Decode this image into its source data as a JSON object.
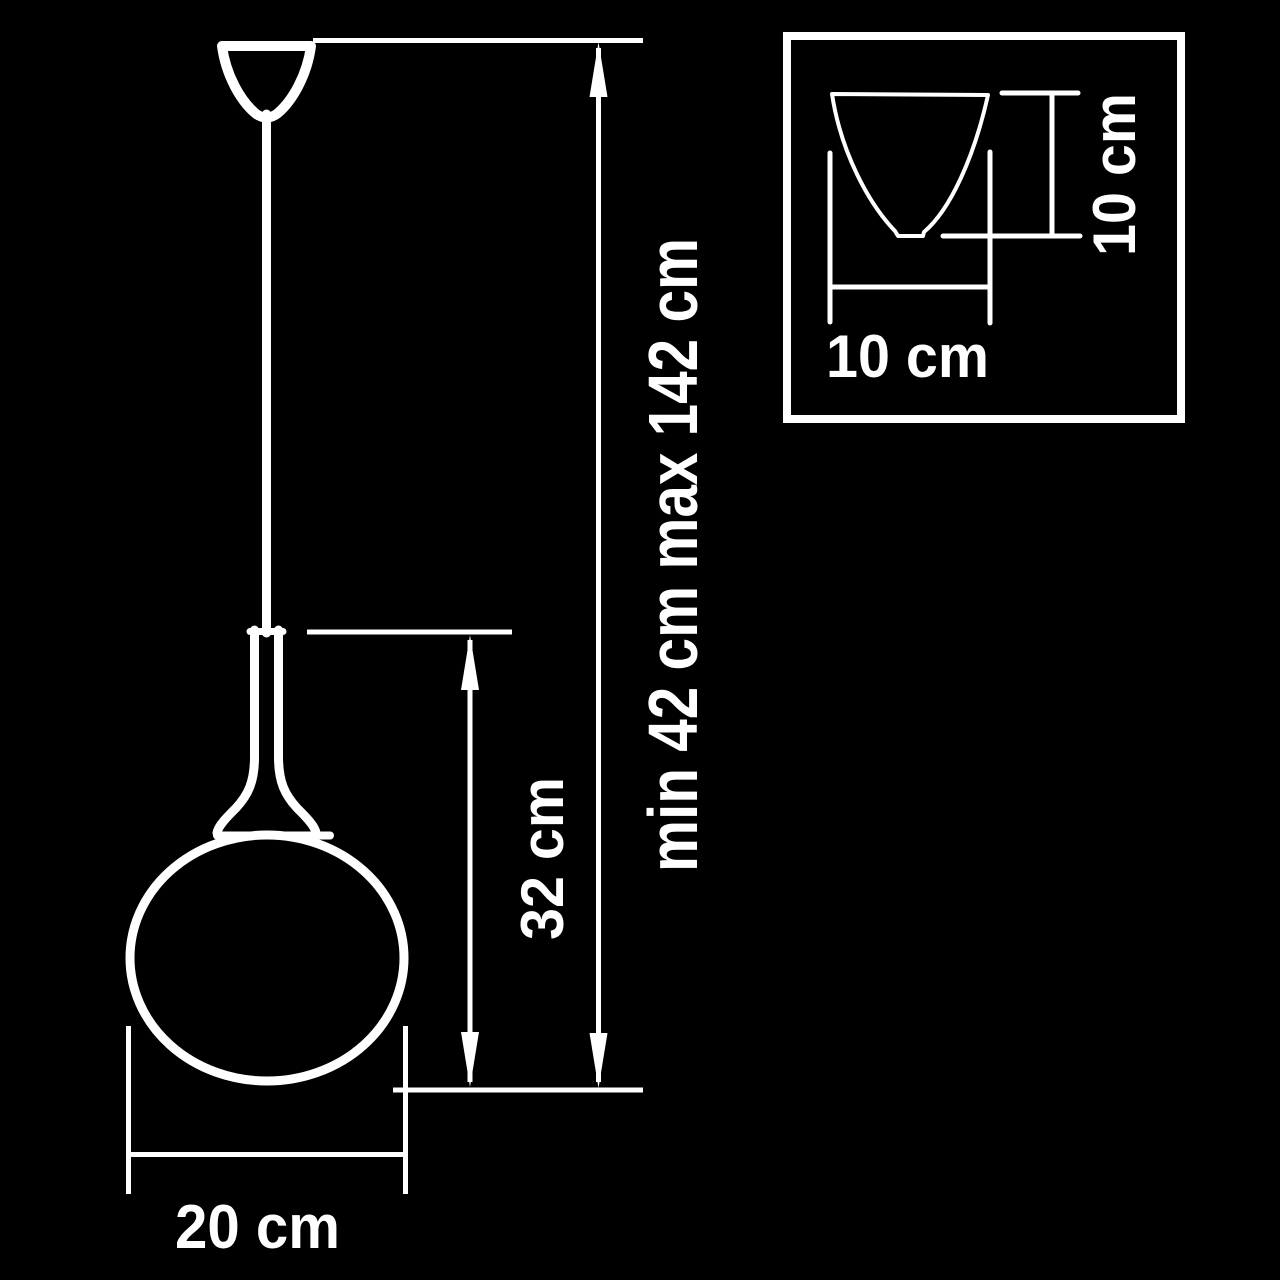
{
  "diagram": {
    "colors": {
      "background": "#000000",
      "line": "#ffffff"
    },
    "pendant": {
      "overall_height_label": "min 42 cm max 142 cm",
      "shade_height_label": "32 cm",
      "shade_diameter_label": "20 cm"
    },
    "canopy_inset": {
      "width_label": "10 cm",
      "height_label": "10 cm"
    }
  }
}
